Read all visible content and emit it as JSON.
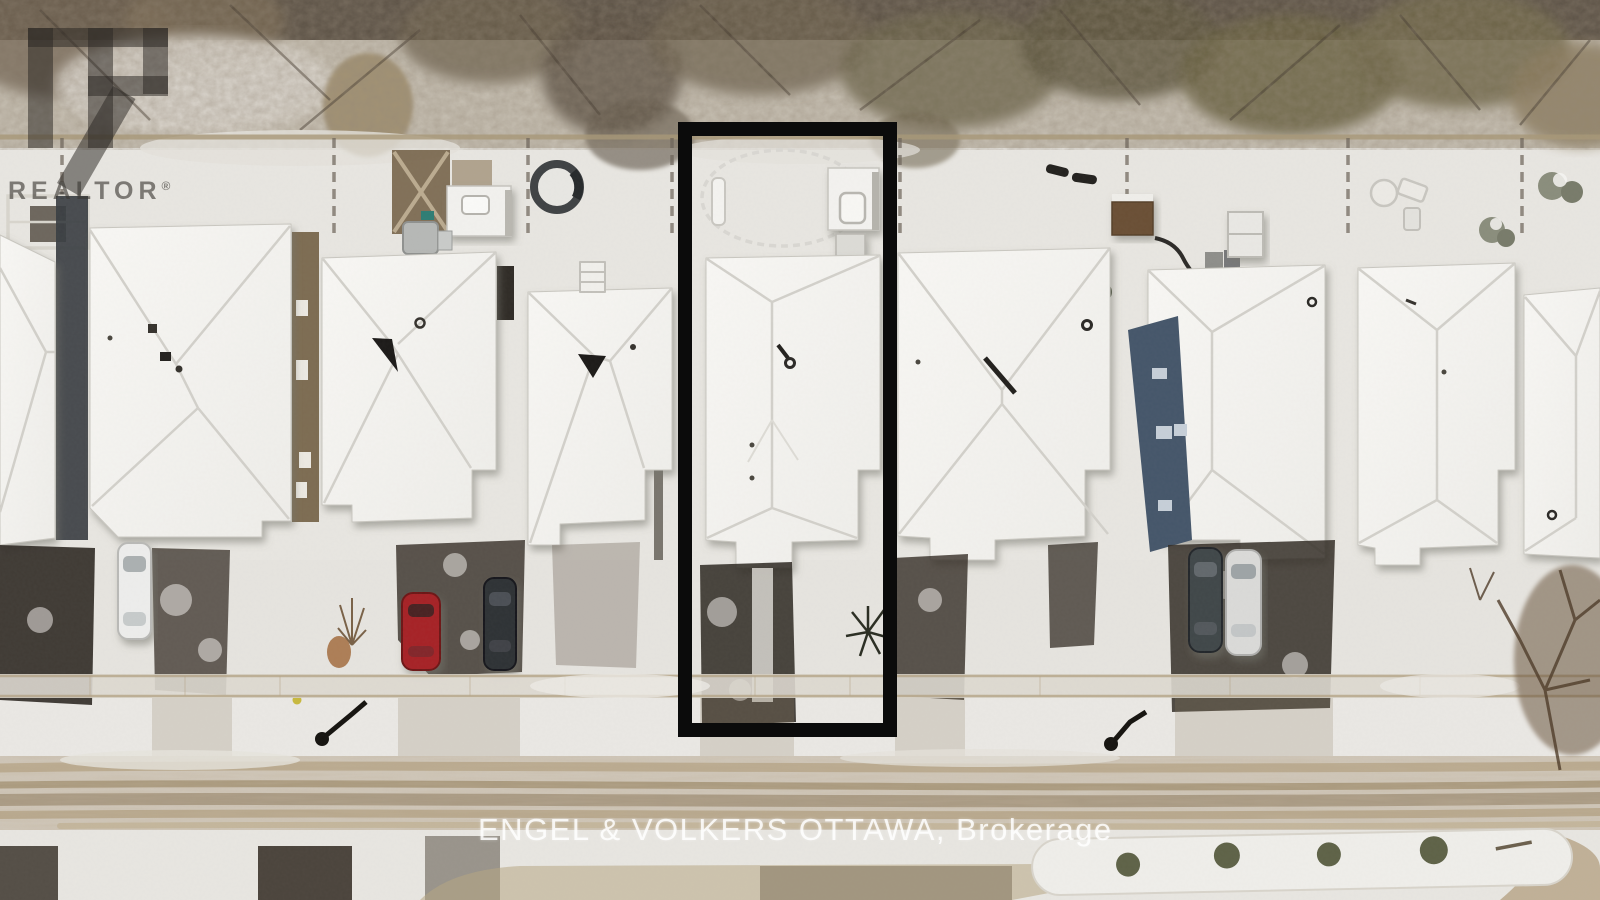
{
  "photo": {
    "kind": "aerial-drone-listing-photo",
    "scene": "Overhead winter view of a suburban street: a row of snow-covered hip roofs, backyards against a treed ravine, driveways with parked cars, a sidewalk and a slushy curving road with a snow median",
    "season": "winter",
    "highlight_outline": {
      "shape": "rectangle",
      "purpose": "subject-property-outline",
      "color": "#0b0b0b"
    }
  },
  "watermarks": {
    "realtor": {
      "wordmark": "REALTOR",
      "registered_mark": "®",
      "logo_letter": "R"
    },
    "brokerage_line": "ENGEL & VOLKERS OTTAWA, Brokerage"
  },
  "palette": {
    "snow": "#eae8e3",
    "roof_white": "#f6f5f2",
    "tree_band": "#c6bfb2",
    "street_slush": "#b3a183",
    "asphalt": "#2f2a23",
    "blue_siding": "#45566a",
    "brown_siding": "#7d6c52",
    "car_red": "#a62226",
    "car_white": "#ededec",
    "car_dark": "#2e3134",
    "car_gray": "#41464a",
    "car_silver": "#dadad8",
    "bush_green": "#5e6247"
  }
}
